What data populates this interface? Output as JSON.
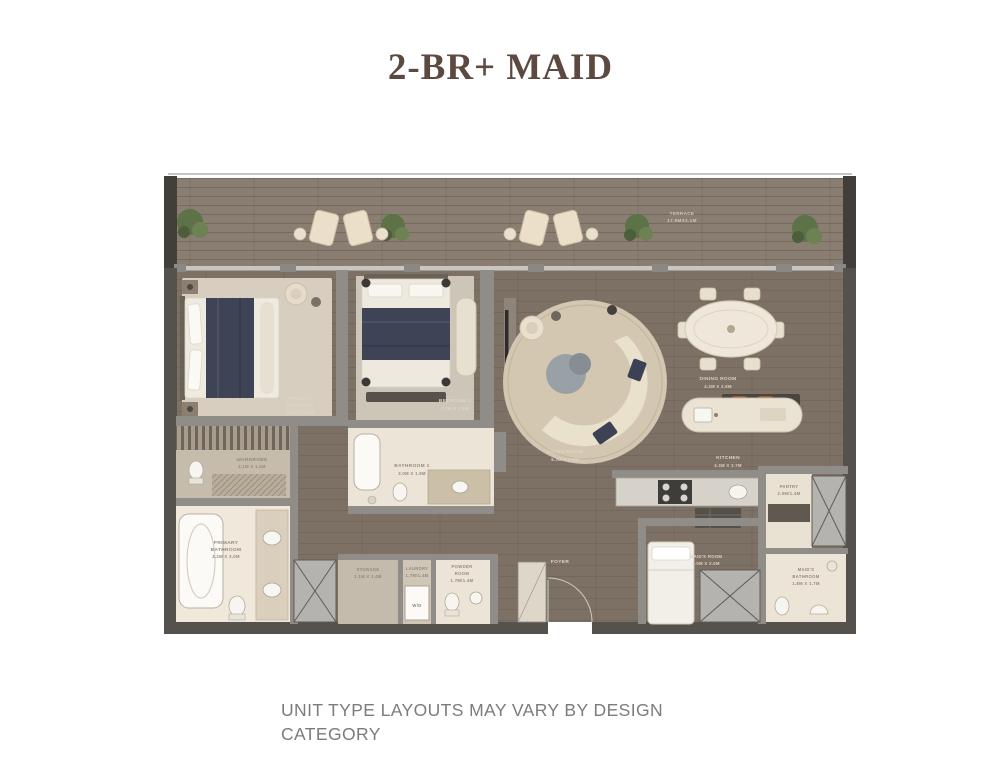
{
  "title": "2-BR+ MAID",
  "footer": {
    "line1": "UNIT TYPE LAYOUTS MAY VARY BY DESIGN",
    "line2": "CATEGORY"
  },
  "colors": {
    "title_text": "#5c4a40",
    "footer_text": "#7c7c7c",
    "interior_wood": "#7d7165",
    "terrace_deck": "#8a7e72",
    "carpet": "#d8cec0",
    "tile": "#ece5d7",
    "wall_gray": "#908d88",
    "bedding_navy": "#3e4355",
    "rug_cream": "#d3c7b1",
    "plant_green": "#5e7248",
    "accent_orange": "#9a5b33"
  },
  "rooms": {
    "terrace": {
      "lines": [
        "TERRACE",
        "17.9MX2.1M"
      ]
    },
    "primary_bedroom": {
      "lines": [
        "PRIMARY",
        "BEDROOM",
        "4.0M X 4.0M"
      ]
    },
    "bedroom1": {
      "lines": [
        "BEDROOM 1",
        "4.2M X 3.6M"
      ]
    },
    "living_room": {
      "lines": [
        "LIVING ROOM",
        "5.3M X 4.4M"
      ]
    },
    "dining_room": {
      "lines": [
        "DINING ROOM",
        "4.3M X 2.9M"
      ]
    },
    "kitchen": {
      "lines": [
        "KITCHEN",
        "4.3M X 2.7M"
      ]
    },
    "wardrobe": {
      "lines": [
        "WARDROBE",
        "2.1M X 1.5M"
      ]
    },
    "primary_bathroom": {
      "lines": [
        "PRIMARY",
        "BATHROOM",
        "3.2M X 3.0M"
      ]
    },
    "bathroom1": {
      "lines": [
        "BATHROOM 1",
        "3.0M X 1.9M"
      ]
    },
    "storage": {
      "lines": [
        "STORAGE",
        "1.1M X 1.4M"
      ]
    },
    "laundry": {
      "lines": [
        "LAUNDRY",
        "1.7M/1.4M"
      ]
    },
    "powder_room": {
      "lines": [
        "POWDER",
        "ROOM",
        "1.7M/1.4M"
      ]
    },
    "foyer": {
      "lines": [
        "FOYER"
      ]
    },
    "maids_room": {
      "lines": [
        "MAID'S ROOM",
        "3.0M X 2.0M"
      ]
    },
    "maids_bathroom": {
      "lines": [
        "MAID'S",
        "BATHROOM",
        "1.8M X 1.7M"
      ]
    },
    "pantry": {
      "lines": [
        "PANTRY",
        "2.0M/1.4M"
      ]
    }
  },
  "labels": {
    "washer_dryer": "W/D"
  }
}
